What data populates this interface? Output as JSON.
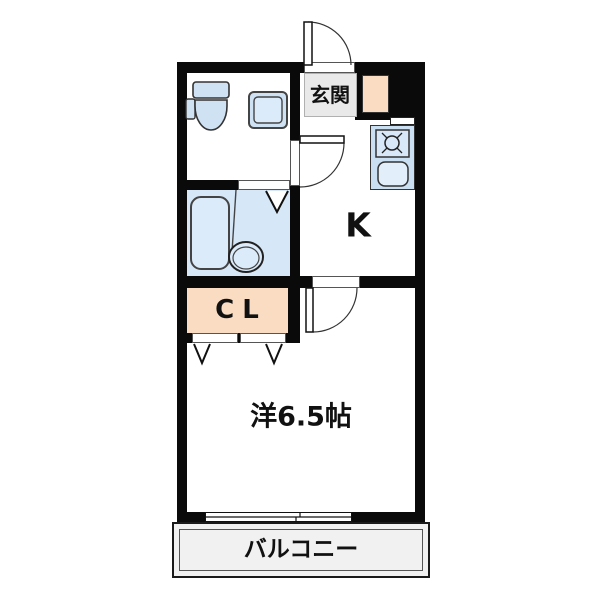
{
  "floorplan": {
    "labels": {
      "entrance": "玄関",
      "kitchen": "K",
      "closet": "CL",
      "main_room": "洋6.5帖",
      "balcony": "バルコニー"
    },
    "colors": {
      "wall": "#0a0a0a",
      "fixture_blue": "#cfe2f4",
      "fixture_blue_light": "#dcebfa",
      "bath_floor_blue": "#d6e7f7",
      "closet_peach": "#f9dcc1",
      "entrance_gray": "#e9e9e9",
      "balcony_gray": "#f1f1f1",
      "background": "#ffffff"
    },
    "fixtures": [
      "toilet",
      "washing-machine-pan",
      "bathtub",
      "wash-basin",
      "gas-stove",
      "kitchen-sink",
      "shoe-cabinet"
    ],
    "features": {
      "doors": [
        "entrance-swing-door",
        "toilet-room-swing-door",
        "main-room-swing-door",
        "bathroom-folding-door",
        "closet-folding-doors"
      ],
      "window": "sliding-window-to-balcony"
    }
  }
}
